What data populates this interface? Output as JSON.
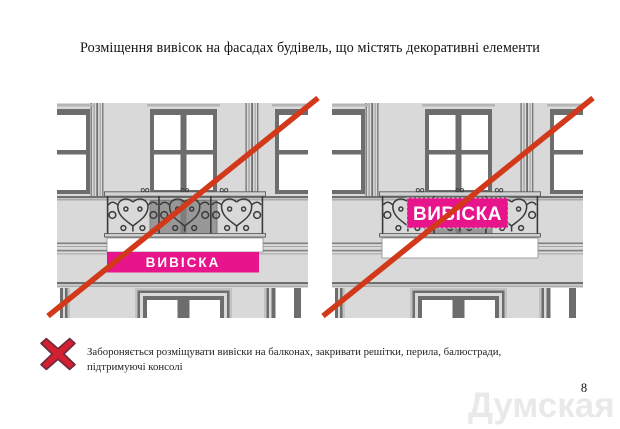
{
  "page": {
    "title": "Розміщення вивісок на фасадах будівель, що містять декоративні елементи",
    "page_number": "8",
    "watermark": "Думская"
  },
  "figures": {
    "left": {
      "sign_label": "ВИВІСКА"
    },
    "right": {
      "sign_label": "ВИВІСКА"
    }
  },
  "note": {
    "lines": [
      "Забороняється розміщувати вивіски на балконах, закривати решітки, перила, балюстради,",
      "підтримуючі консолі"
    ]
  },
  "colors": {
    "sign_pink": "#e8148b",
    "prohibition_red": "#d2391a",
    "x_mark_red": "#d32030"
  }
}
